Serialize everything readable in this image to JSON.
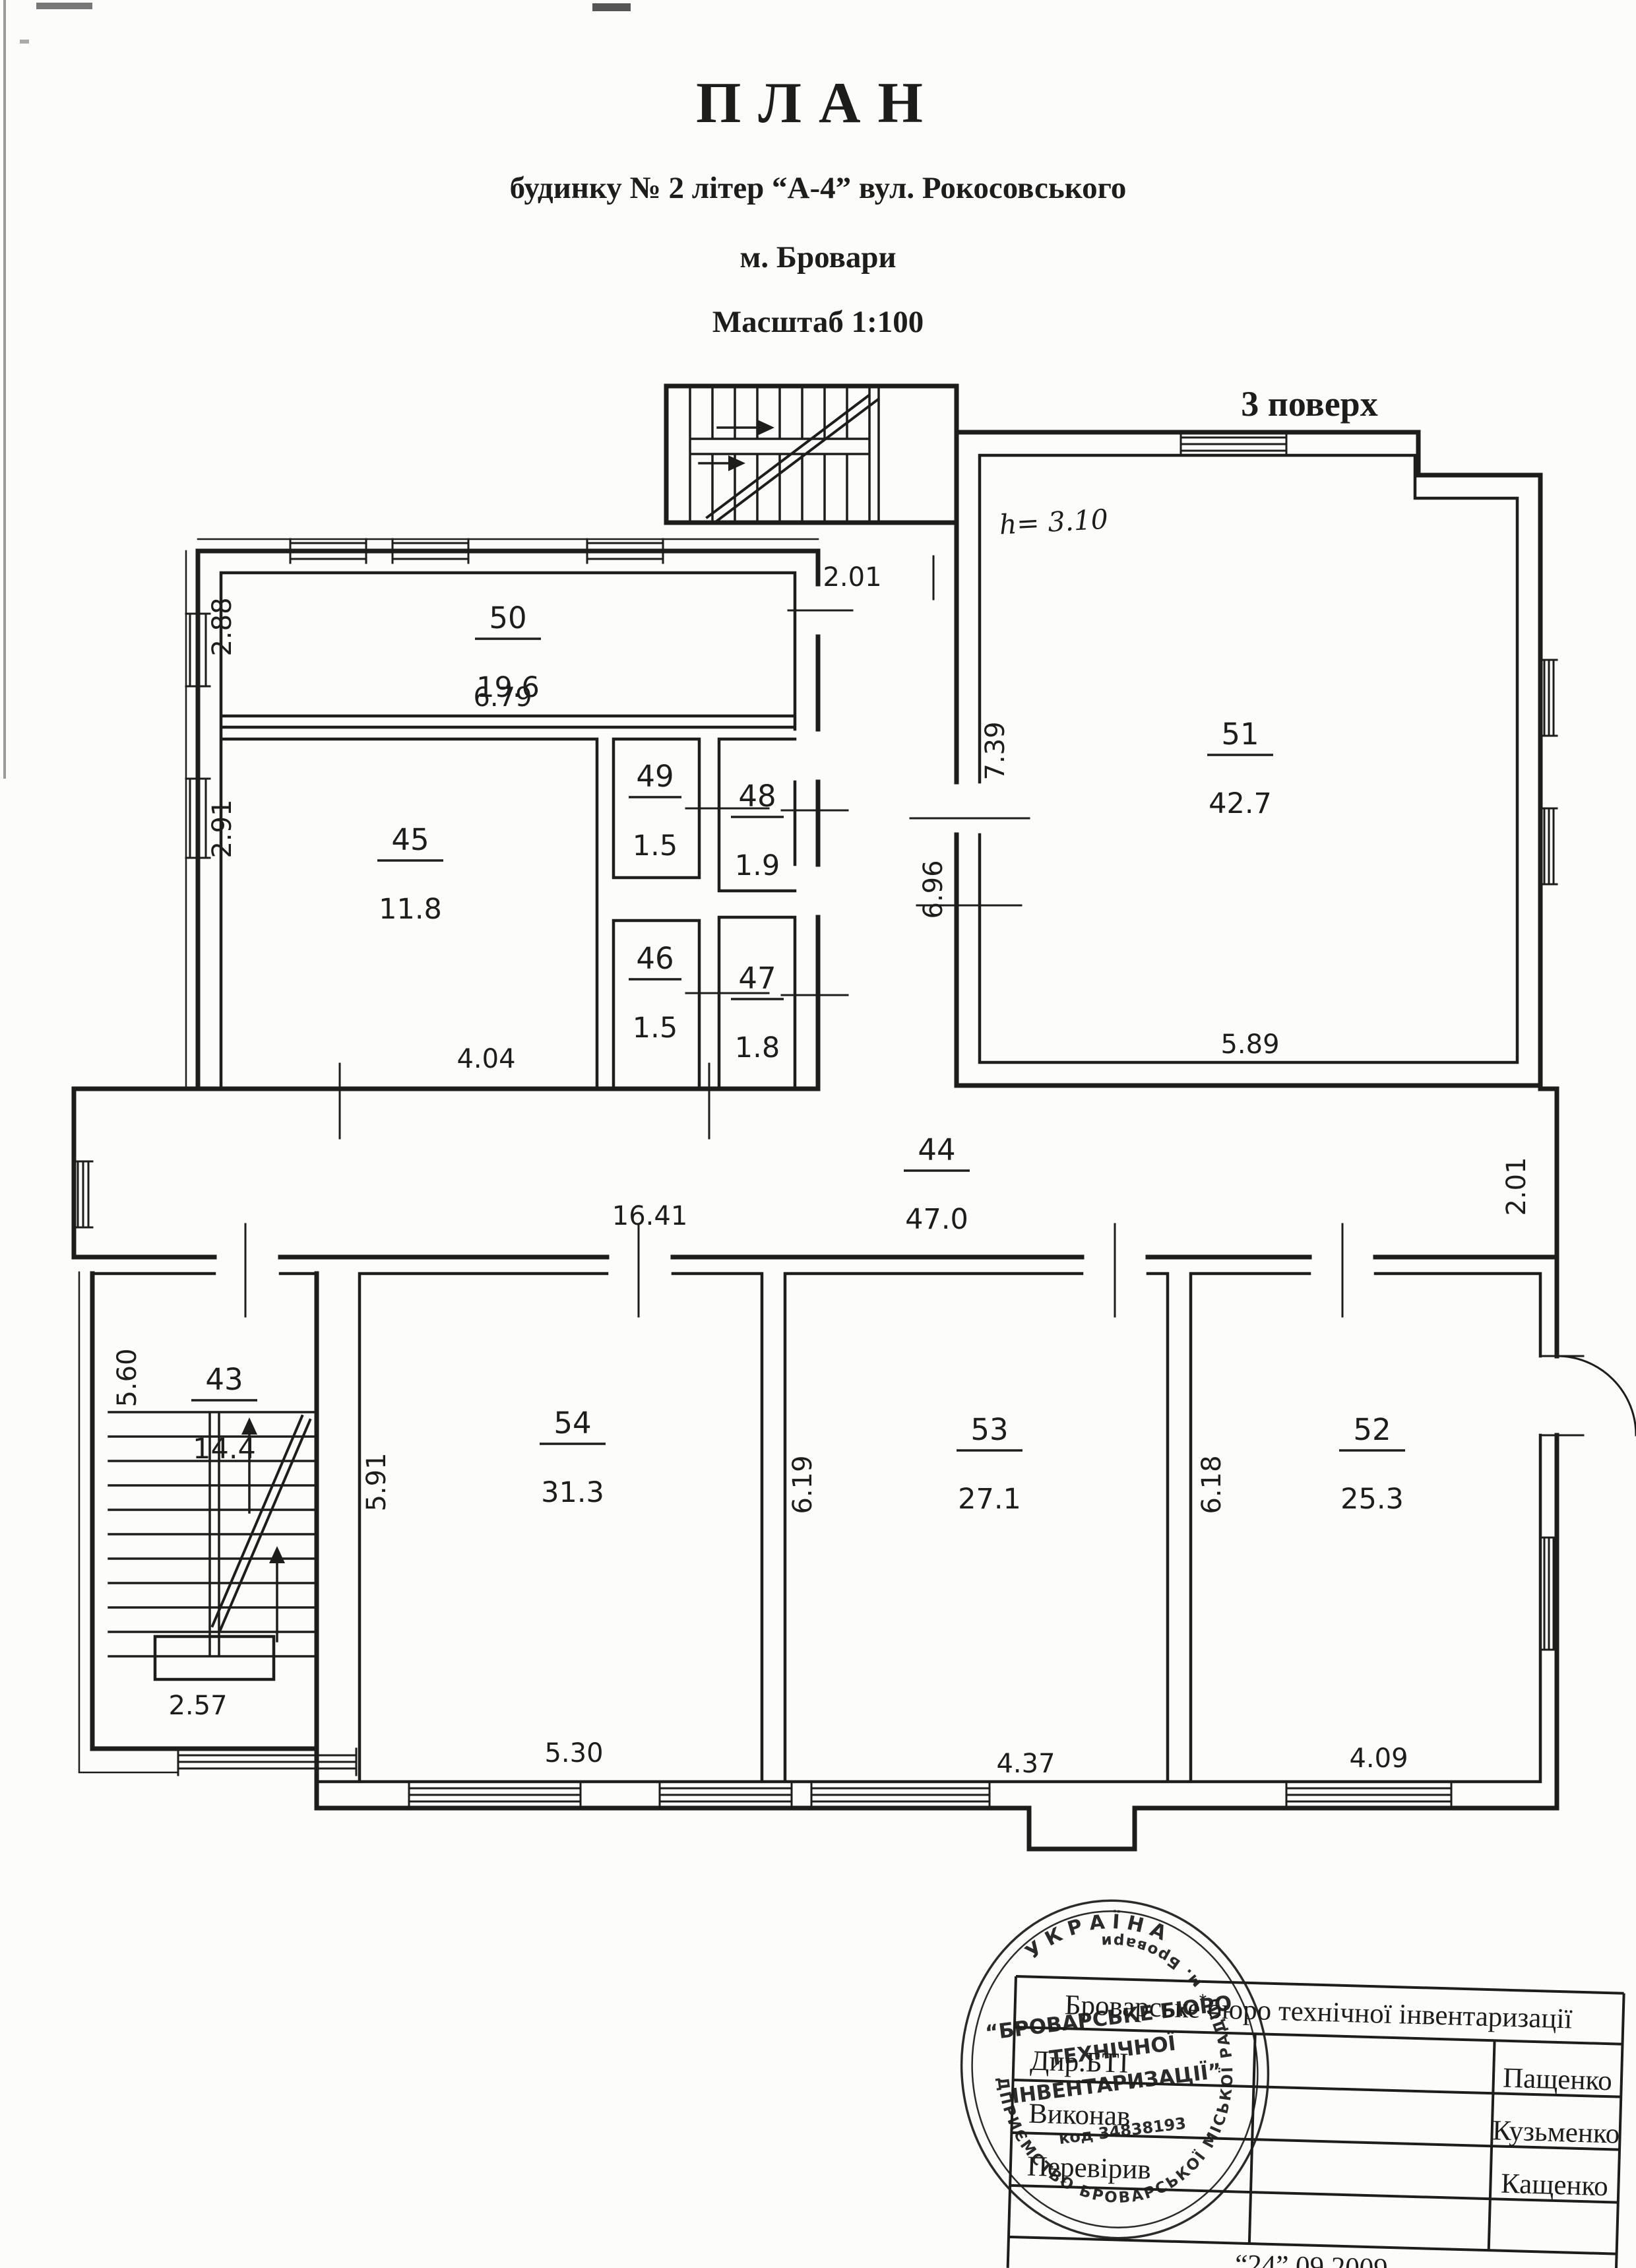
{
  "header": {
    "title": "ПЛАН",
    "address_line": "будинку № 2 літер “А-4” вул. Рокосовського",
    "city_line": "м. Бровари",
    "scale_line": "Масштаб  1:100",
    "floor_label": "3 поверх",
    "height_note": "h= 3.10"
  },
  "rooms": [
    {
      "number": "50",
      "area": "19.6"
    },
    {
      "number": "45",
      "area": "11.8"
    },
    {
      "number": "49",
      "area": "1.5"
    },
    {
      "number": "48",
      "area": "1.9"
    },
    {
      "number": "46",
      "area": "1.5"
    },
    {
      "number": "47",
      "area": "1.8"
    },
    {
      "number": "51",
      "area": "42.7"
    },
    {
      "number": "44",
      "area": "47.0"
    },
    {
      "number": "43",
      "area": "14.4"
    },
    {
      "number": "54",
      "area": "31.3"
    },
    {
      "number": "53",
      "area": "27.1"
    },
    {
      "number": "52",
      "area": "25.3"
    }
  ],
  "dims": [
    {
      "value": "2.01"
    },
    {
      "value": "2.88"
    },
    {
      "value": "6.79"
    },
    {
      "value": "2.91"
    },
    {
      "value": "4.04"
    },
    {
      "value": "7.39"
    },
    {
      "value": "6.96"
    },
    {
      "value": "5.89"
    },
    {
      "value": "16.41"
    },
    {
      "value": "2.01"
    },
    {
      "value": "5.60"
    },
    {
      "value": "2.57"
    },
    {
      "value": "5.91"
    },
    {
      "value": "5.30"
    },
    {
      "value": "6.19"
    },
    {
      "value": "4.37"
    },
    {
      "value": "6.18"
    },
    {
      "value": "4.09"
    }
  ],
  "stamp": {
    "country": "УКРАЇНА",
    "ring_text": "* КОМУНАЛЬНЕ ПІДПРИЄМСТВО БРОВАРСЬКОЇ МІСЬКОЇ РАДИ *  м. Бровари",
    "org_line1": "“БРОВАРСЬКЕ БЮРО",
    "org_line2": "ТЕХНІЧНОЇ",
    "org_line3": "ІНВЕНТАРИЗАЦІЇ”",
    "code_line": "код 34838193"
  },
  "table": {
    "org_title": "Броварське бюро технічної інвентаризації",
    "rows": [
      {
        "role": "Дир.БТІ",
        "name": "Пащенко"
      },
      {
        "role": "Виконав",
        "name": "Кузьменко"
      },
      {
        "role": "Перевірив",
        "name": "Кащенко"
      }
    ],
    "date_line": "“24” 09  2009"
  }
}
